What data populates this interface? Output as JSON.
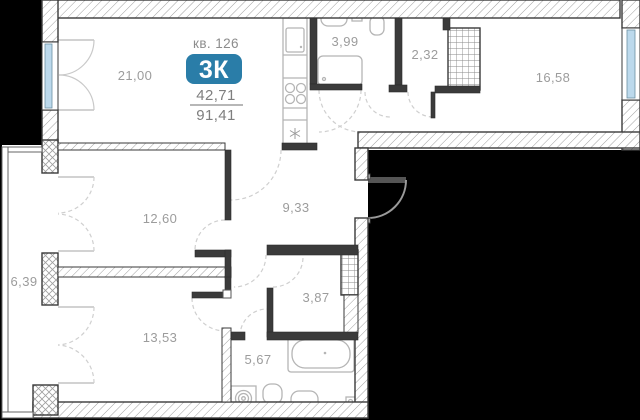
{
  "plan": {
    "apartment_number_label": "кв. 126",
    "type_badge": "3К",
    "living_area": "42,71",
    "total_area": "91,41",
    "colors": {
      "badge": "#2a7da8",
      "window": "#bcd9ec",
      "wall_dark": "#3b3b3b",
      "label_gray": "#9c9c9c"
    },
    "rooms": [
      {
        "name": "living-kitchen",
        "area": "21,00"
      },
      {
        "name": "bathroom-upper",
        "area": "3,99"
      },
      {
        "name": "wardrobe",
        "area": "2,32"
      },
      {
        "name": "bedroom-right",
        "area": "16,58"
      },
      {
        "name": "bedroom-middle",
        "area": "12,60"
      },
      {
        "name": "hallway",
        "area": "9,33"
      },
      {
        "name": "balcony",
        "area": "6,39"
      },
      {
        "name": "bedroom-lower",
        "area": "13,53"
      },
      {
        "name": "inner-hall",
        "area": "3,87"
      },
      {
        "name": "bathroom-lower",
        "area": "5,67"
      }
    ],
    "fixtures": [
      "kitchen-sink",
      "stove",
      "refrigerator",
      "water-heater",
      "washbasin-upper",
      "toilet-upper",
      "shower-tray",
      "bathtub",
      "washing-machine",
      "toilet-lower",
      "washbasin-lower",
      "floor-drain",
      "ventilation-shaft-top",
      "ventilation-shaft-middle"
    ]
  }
}
